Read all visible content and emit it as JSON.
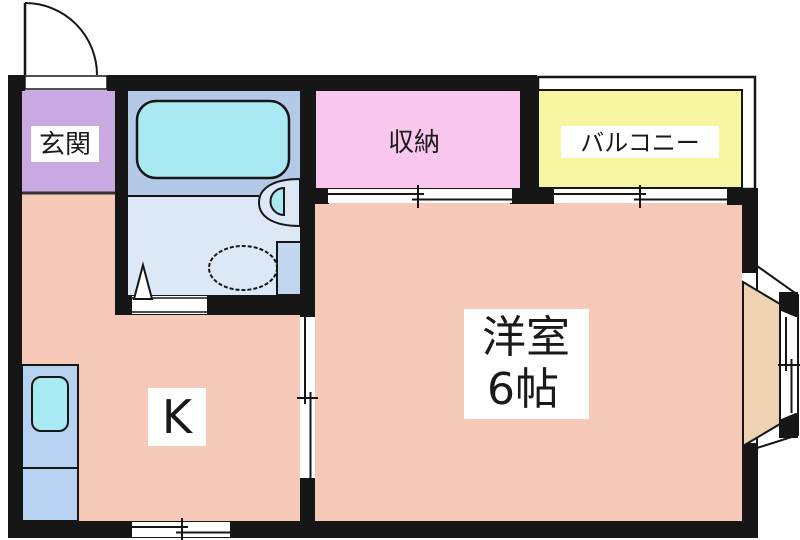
{
  "plan": {
    "type": "floor-plan",
    "layout_name": "1K apartment"
  },
  "rooms": {
    "genkan": {
      "label": "玄関"
    },
    "storage": {
      "label": "収納"
    },
    "balcony": {
      "label": "バルコニー"
    },
    "kitchen": {
      "label": "K"
    },
    "western_room": {
      "label": "洋室",
      "size": "6帖"
    }
  },
  "fixtures": {
    "entrance_door": "hinged-door-with-swing-arc",
    "bathtub": "bathtub",
    "washbasin": "wall-mounted-washbasin",
    "toilet": "toilet-with-tank",
    "kitchen_counter": "kitchen-counter-with-sink",
    "bay_window": "angled-bay-window",
    "storage_door": "sliding-door",
    "balcony_window": "sliding-window",
    "kitchen_room_door": "sliding-door",
    "kitchen_window": "sliding-window",
    "bathroom_door": "inward-door"
  },
  "colors": {
    "wall": "#161616",
    "floor_main": "#f6c9b8",
    "genkan": "#c8a9e2",
    "storage": "#f9c6ee",
    "balcony": "#f8f5a2",
    "bath_upper": "#b4c9e8",
    "bath_lower": "#dde8f7",
    "fixture_cyan": "#a9e9f1",
    "counter": "#b6d2f0",
    "toilet_tank": "#c2d6f0",
    "bay_floor": "#eed2b2",
    "label_bg": "#ffffff",
    "text": "#1a1a1a"
  }
}
